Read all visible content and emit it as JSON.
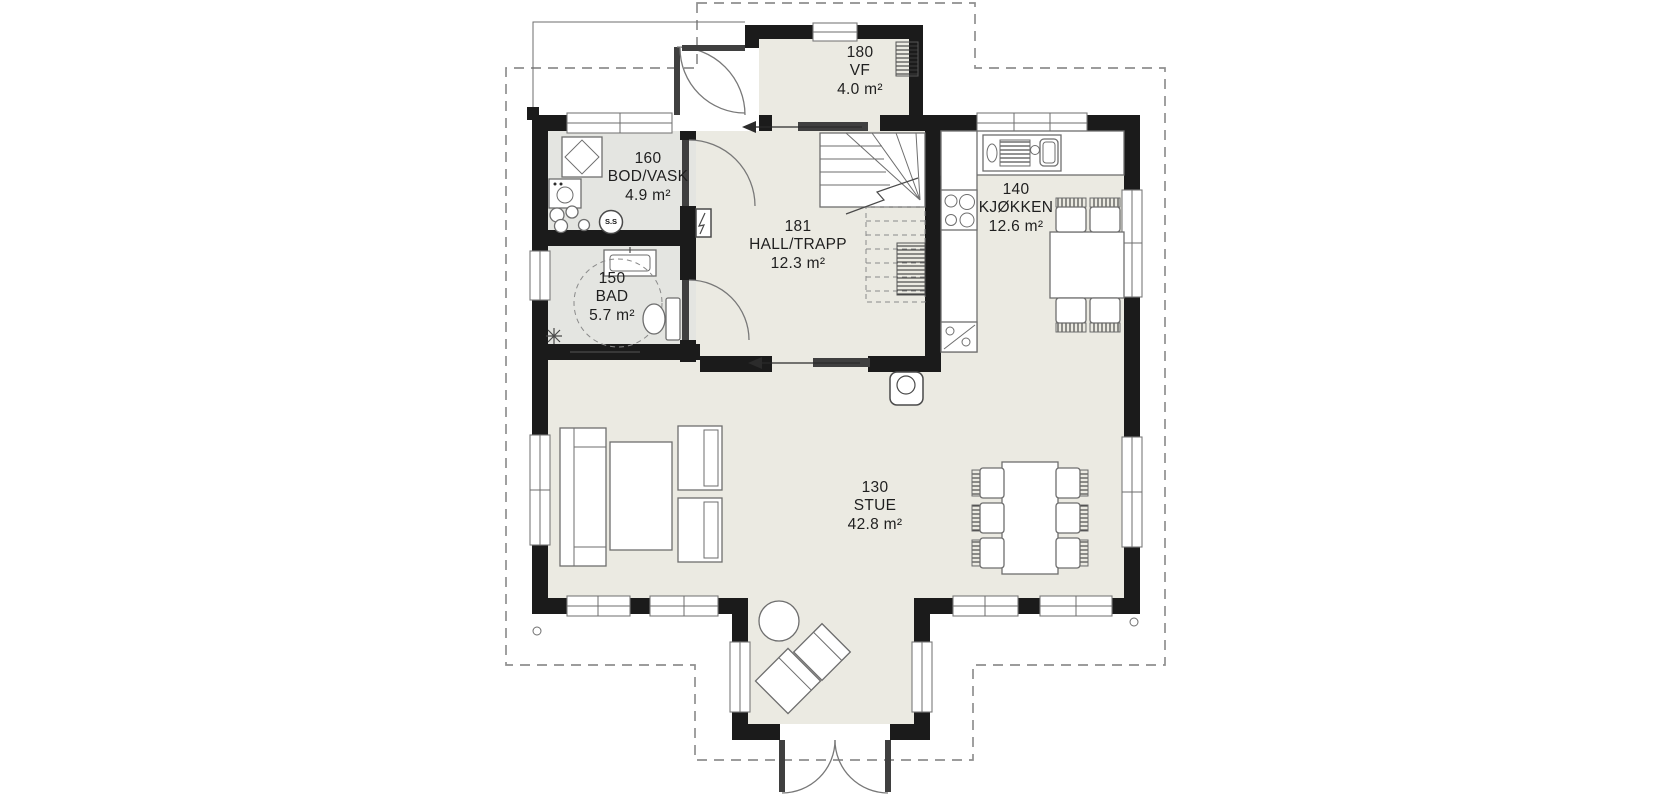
{
  "plan": {
    "rooms": [
      {
        "number": "180",
        "name": "VF",
        "area": "4.0 m²"
      },
      {
        "number": "160",
        "name": "BOD/VASK",
        "area": "4.9 m²"
      },
      {
        "number": "150",
        "name": "BAD",
        "area": "5.7 m²"
      },
      {
        "number": "181",
        "name": "HALL/TRAPP",
        "area": "12.3 m²"
      },
      {
        "number": "140",
        "name": "KJØKKEN",
        "area": "12.6 m²"
      },
      {
        "number": "130",
        "name": "STUE",
        "area": "42.8 m²"
      }
    ],
    "annotations": {
      "water_heater_label": "S.S"
    },
    "colors": {
      "wall": "#1b1b1b",
      "main_floor": "#ebeae2",
      "wet_room_floor": "#e4e5e1",
      "roof_outline_dash": "#8f8f8f",
      "text": "#1f1f1f"
    }
  }
}
